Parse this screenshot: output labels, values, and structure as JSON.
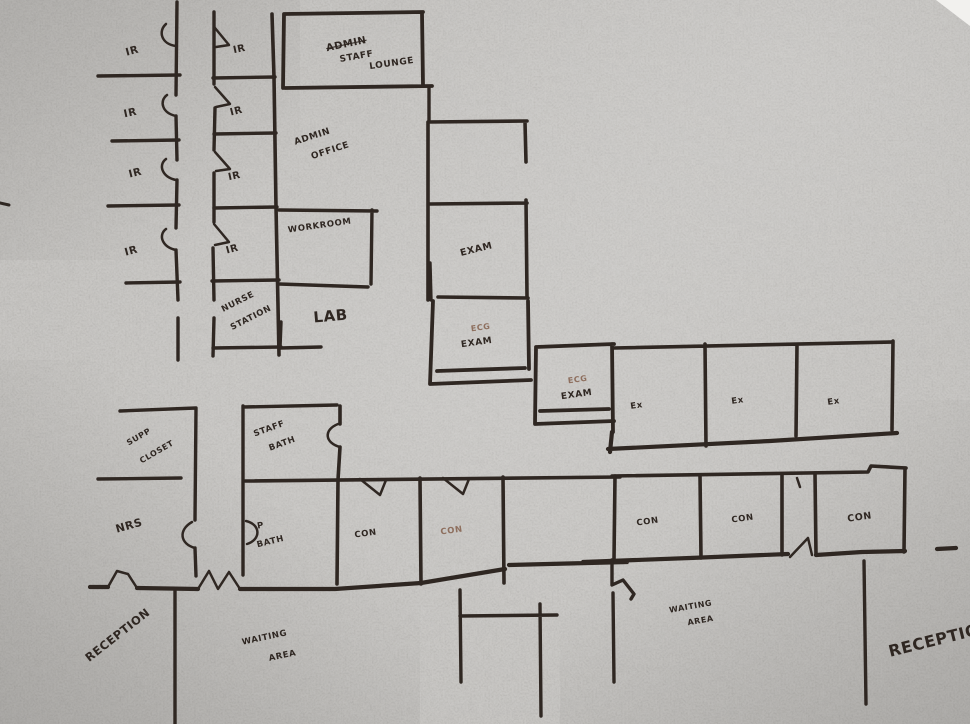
{
  "palette": {
    "paper": "#a4a29f",
    "paper_light": "#c7c5c1",
    "paper_corner": "#f2f1ee",
    "ink": "#2f2722",
    "ink_faint": "#8e6f5e"
  },
  "floor_plan": {
    "title": "hand-drawn medical office floor plan",
    "labels": [
      {
        "name": "ir-left-1",
        "text": "IR",
        "x": 133,
        "y": 54,
        "rotate": -15,
        "size": 10.5
      },
      {
        "name": "ir-left-2",
        "text": "IR",
        "x": 131,
        "y": 116,
        "rotate": -12,
        "size": 10.5
      },
      {
        "name": "ir-left-3",
        "text": "IR",
        "x": 136,
        "y": 176,
        "rotate": -14,
        "size": 10.5
      },
      {
        "name": "ir-left-4",
        "text": "IR",
        "x": 132,
        "y": 254,
        "rotate": -15,
        "size": 10.5
      },
      {
        "name": "ir-right-1",
        "text": "IR",
        "x": 240,
        "y": 52,
        "rotate": -12,
        "size": 10
      },
      {
        "name": "ir-right-2",
        "text": "IR",
        "x": 237,
        "y": 114,
        "rotate": -14,
        "size": 10
      },
      {
        "name": "ir-right-3",
        "text": "IR",
        "x": 235,
        "y": 179,
        "rotate": -12,
        "size": 10
      },
      {
        "name": "ir-right-4",
        "text": "IR",
        "x": 233,
        "y": 252,
        "rotate": -15,
        "size": 10
      },
      {
        "name": "staff-lounge-struck-word",
        "text": "ADMIN",
        "x": 347,
        "y": 47,
        "rotate": -12,
        "size": 10,
        "strike": true
      },
      {
        "name": "staff-lounge-line-1",
        "text": "STAFF",
        "x": 357,
        "y": 59,
        "rotate": -10,
        "size": 9
      },
      {
        "name": "staff-lounge-line-2",
        "text": "LOUNGE",
        "x": 392,
        "y": 66,
        "rotate": -8,
        "size": 9
      },
      {
        "name": "admin-office-line-1",
        "text": "ADMIN",
        "x": 313,
        "y": 139,
        "rotate": -18,
        "size": 9
      },
      {
        "name": "admin-office-line-2",
        "text": "OFFICE",
        "x": 331,
        "y": 153,
        "rotate": -18,
        "size": 9
      },
      {
        "name": "workroom",
        "text": "WORKROOM",
        "x": 320,
        "y": 228,
        "rotate": -8,
        "size": 8.5
      },
      {
        "name": "nurse-station-line-1",
        "text": "NURSE",
        "x": 239,
        "y": 304,
        "rotate": -27,
        "size": 8.5
      },
      {
        "name": "nurse-station-line-2",
        "text": "STATION",
        "x": 252,
        "y": 320,
        "rotate": -27,
        "size": 8.5
      },
      {
        "name": "lab",
        "text": "LAB",
        "x": 331,
        "y": 321,
        "rotate": -5,
        "size": 15
      },
      {
        "name": "exam-upper",
        "text": "EXAM",
        "x": 477,
        "y": 252,
        "rotate": -14,
        "size": 9.5
      },
      {
        "name": "ecg-exam-1-top",
        "text": "ECG",
        "x": 481,
        "y": 330,
        "rotate": -8,
        "size": 8,
        "faint": true
      },
      {
        "name": "ecg-exam-1-bottom",
        "text": "EXAM",
        "x": 477,
        "y": 345,
        "rotate": -8,
        "size": 9
      },
      {
        "name": "ecg-exam-2-top",
        "text": "ECG",
        "x": 578,
        "y": 382,
        "rotate": -8,
        "size": 8,
        "faint": true
      },
      {
        "name": "ecg-exam-2-bottom",
        "text": "EXAM",
        "x": 577,
        "y": 397,
        "rotate": -8,
        "size": 9
      },
      {
        "name": "ex-1",
        "text": "Ex",
        "x": 637,
        "y": 408,
        "rotate": -8,
        "size": 8.5
      },
      {
        "name": "ex-2",
        "text": "Ex",
        "x": 738,
        "y": 403,
        "rotate": -8,
        "size": 8.5
      },
      {
        "name": "ex-3",
        "text": "Ex",
        "x": 834,
        "y": 404,
        "rotate": -8,
        "size": 8.5
      },
      {
        "name": "supp-closet-line-1",
        "text": "SUPP",
        "x": 140,
        "y": 439,
        "rotate": -30,
        "size": 8
      },
      {
        "name": "supp-closet-line-2",
        "text": "CLOSET",
        "x": 158,
        "y": 454,
        "rotate": -30,
        "size": 8
      },
      {
        "name": "staff-bath-line-1",
        "text": "STAFF",
        "x": 270,
        "y": 431,
        "rotate": -20,
        "size": 8.5
      },
      {
        "name": "staff-bath-line-2",
        "text": "BATH",
        "x": 283,
        "y": 446,
        "rotate": -20,
        "size": 8.5
      },
      {
        "name": "nrs",
        "text": "NRS",
        "x": 130,
        "y": 529,
        "rotate": -16,
        "size": 11
      },
      {
        "name": "p-bath-line-1",
        "text": "P",
        "x": 261,
        "y": 528,
        "rotate": -10,
        "size": 8.5
      },
      {
        "name": "p-bath-line-2",
        "text": "BATH",
        "x": 271,
        "y": 544,
        "rotate": -14,
        "size": 8.5
      },
      {
        "name": "con-1",
        "text": "CON",
        "x": 366,
        "y": 536,
        "rotate": -8,
        "size": 8.5
      },
      {
        "name": "con-2",
        "text": "CON",
        "x": 452,
        "y": 533,
        "rotate": -8,
        "size": 8.5,
        "faint": true
      },
      {
        "name": "con-3",
        "text": "CON",
        "x": 648,
        "y": 524,
        "rotate": -8,
        "size": 8.5
      },
      {
        "name": "con-4",
        "text": "CON",
        "x": 743,
        "y": 521,
        "rotate": -8,
        "size": 8.5
      },
      {
        "name": "con-5",
        "text": "CON",
        "x": 860,
        "y": 520,
        "rotate": -8,
        "size": 9.5
      },
      {
        "name": "waiting-area-left-line-1",
        "text": "WAITING",
        "x": 265,
        "y": 640,
        "rotate": -12,
        "size": 8.5
      },
      {
        "name": "waiting-area-left-line-2",
        "text": "AREA",
        "x": 283,
        "y": 658,
        "rotate": -12,
        "size": 8.5
      },
      {
        "name": "waiting-area-right-line-1",
        "text": "WAITING",
        "x": 691,
        "y": 609,
        "rotate": -10,
        "size": 8
      },
      {
        "name": "waiting-area-right-line-2",
        "text": "AREA",
        "x": 701,
        "y": 623,
        "rotate": -10,
        "size": 8
      },
      {
        "name": "reception-left",
        "text": "RECEPTION",
        "x": 120,
        "y": 638,
        "rotate": -38,
        "size": 11.5
      },
      {
        "name": "reception-right",
        "text": "RECEPTION",
        "x": 942,
        "y": 644,
        "rotate": -14,
        "size": 16
      }
    ]
  }
}
